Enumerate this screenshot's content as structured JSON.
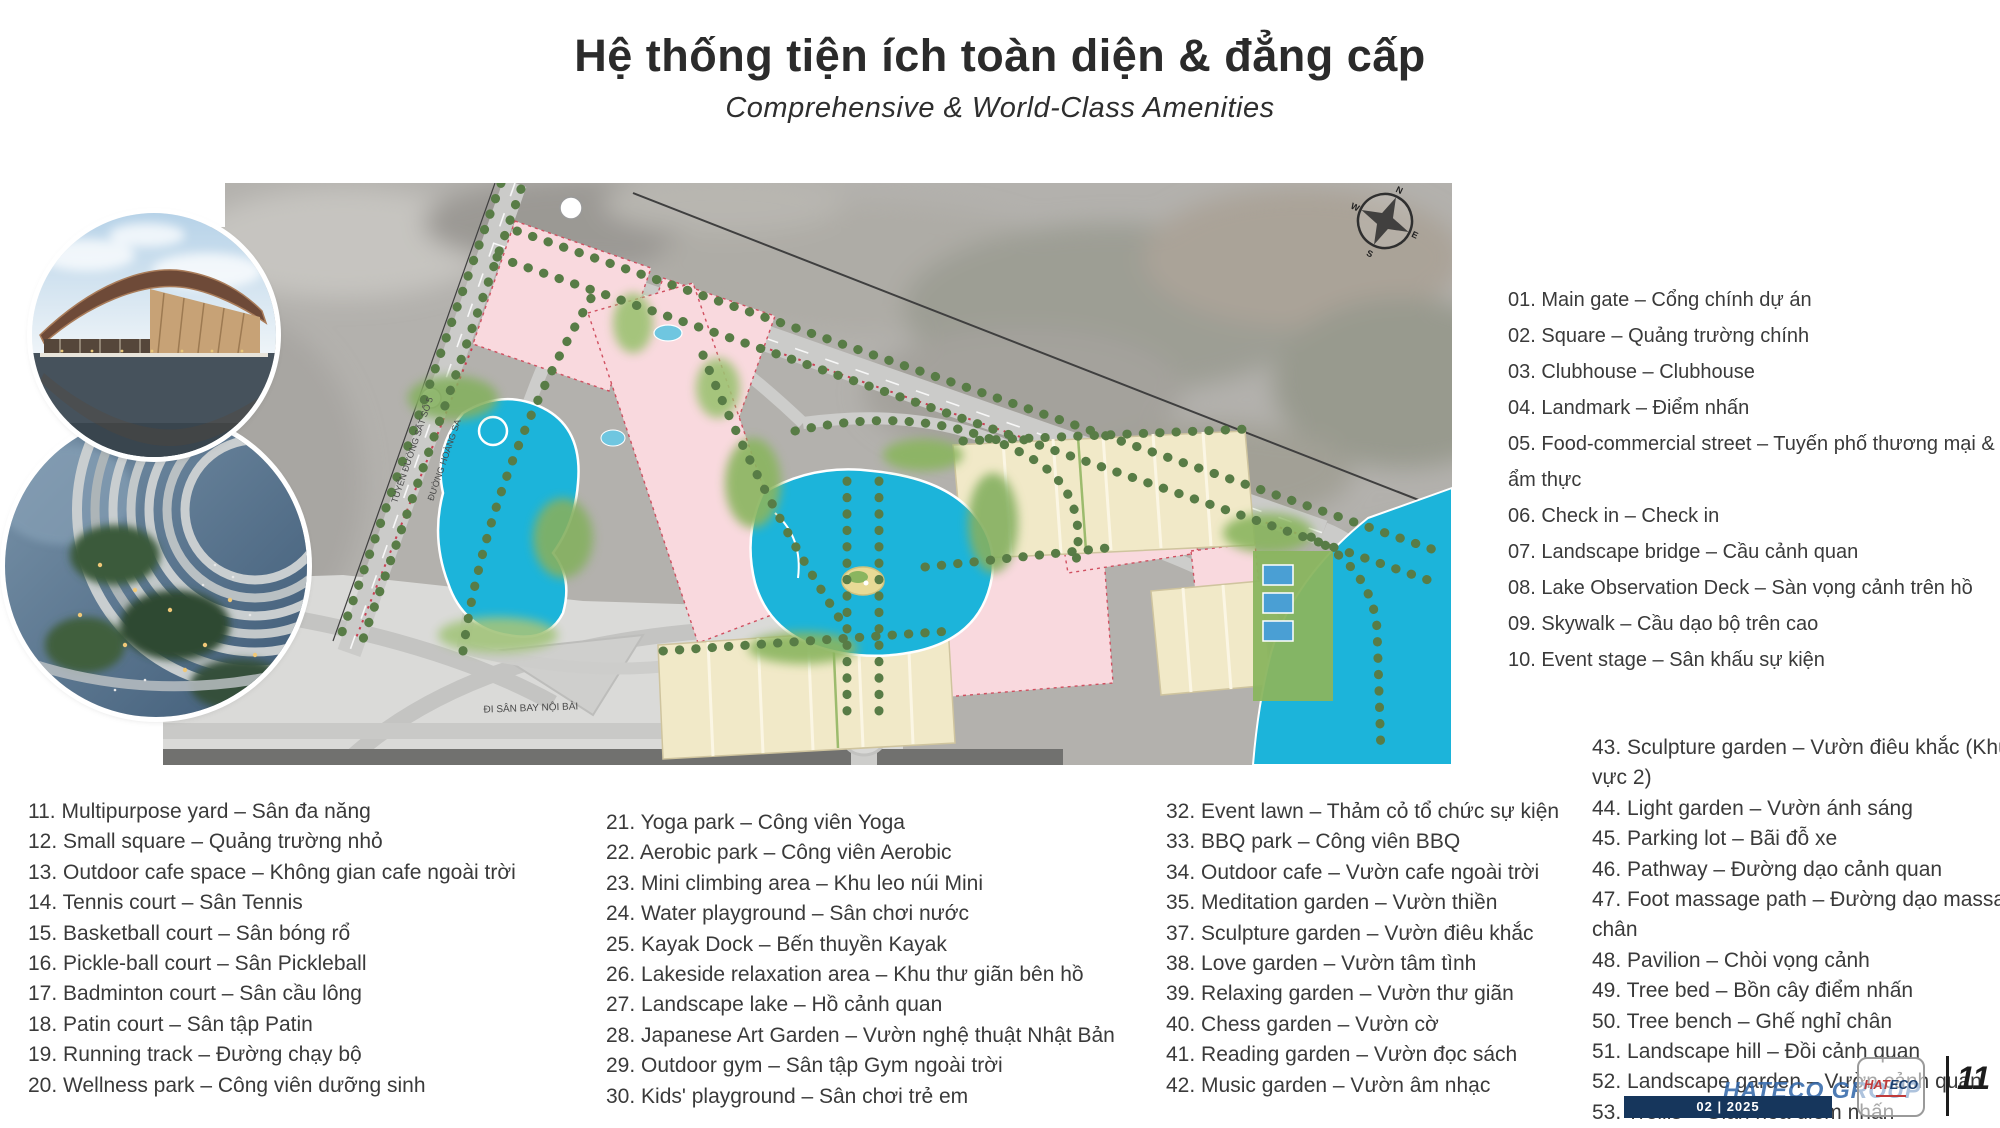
{
  "title": {
    "main": "Hệ thống tiện ích toàn diện & đẳng cấp",
    "subtitle": "Comprehensive & World-Class Amenities"
  },
  "map": {
    "compass": {
      "n": "N",
      "e": "E",
      "s": "S",
      "w": "W"
    },
    "labels": {
      "railway": "TUYẾN ĐƯỜNG SẮT SỐ 5",
      "road_left": "ĐƯỜNG HOÀNG SA",
      "airport": "ĐI SÂN BAY NỘI BÀI"
    },
    "colors": {
      "lake": "#1cb4da",
      "plot_pink": "#f9d9de",
      "rowhouse_cream": "#f1e9c8",
      "road_gray": "#cbcbc9"
    }
  },
  "amenities": {
    "col_right": [
      "01. Main gate – Cổng chính dự án",
      "02. Square – Quảng trường chính",
      "03. Clubhouse – Clubhouse",
      "04. Landmark – Điểm nhấn",
      "05. Food-commercial street – Tuyến phố thương mại & ẩm thực",
      "06. Check in – Check in",
      "07. Landscape bridge – Cầu cảnh quan",
      "08. Lake Observation Deck – Sàn vọng cảnh trên hồ",
      "09. Skywalk – Cầu dạo bộ trên cao",
      "10. Event stage – Sân khấu sự kiện"
    ],
    "col_1": [
      "11. Multipurpose yard – Sân đa năng",
      "12. Small square – Quảng trường nhỏ",
      "13. Outdoor cafe space – Không gian cafe ngoài trời",
      "14. Tennis court – Sân Tennis",
      "15. Basketball court – Sân bóng rổ",
      "16. Pickle-ball court – Sân Pickleball",
      "17. Badminton court – Sân cầu lông",
      "18. Patin court – Sân tập Patin",
      "19. Running track – Đường chạy bộ",
      "20. Wellness park – Công viên dưỡng sinh"
    ],
    "col_2": [
      "21. Yoga park – Công viên Yoga",
      "22. Aerobic park – Công viên Aerobic",
      "23. Mini climbing area – Khu leo núi Mini",
      "24. Water playground – Sân chơi nước",
      "25. Kayak Dock – Bến thuyền Kayak",
      "26. Lakeside relaxation area – Khu thư giãn bên hồ",
      "27. Landscape lake – Hồ cảnh quan",
      "28. Japanese Art Garden – Vườn nghệ thuật Nhật Bản",
      "29. Outdoor gym – Sân tập Gym ngoài trời",
      "30. Kids' playground – Sân chơi trẻ em"
    ],
    "col_3": [
      "32. Event lawn – Thảm cỏ tổ chức sự kiện",
      "33. BBQ park – Công viên BBQ",
      "34. Outdoor cafe – Vườn cafe ngoài trời",
      "35. Meditation garden – Vườn thiền",
      "37. Sculpture garden – Vườn điêu khắc",
      "38. Love garden – Vườn tâm tình",
      "39. Relaxing garden – Vườn thư giãn",
      "40. Chess garden – Vườn cờ",
      "41. Reading garden – Vườn đọc sách",
      "42. Music garden – Vườn âm nhạc"
    ],
    "col_4": [
      "43. Sculpture garden – Vườn điêu khắc (Khu vực 2)",
      "44. Light garden – Vườn ánh sáng",
      "45. Parking lot – Bãi đỗ xe",
      "46. Pathway – Đường dạo cảnh quan",
      "47. Foot massage path – Đường dạo massage chân",
      "48. Pavilion – Chòi vọng cảnh",
      "49. Tree bed – Bồn cây điểm nhấn",
      "50. Tree bench – Ghế nghỉ chân",
      "51. Landscape hill – Đồi cảnh quan",
      "52. Landscape garden – Vườn cảnh quan",
      "53. Trellis – Giàn hoa điểm nhấn"
    ]
  },
  "footer": {
    "brand_watermark": "HATECO GROUP",
    "date_badge": "02 | 2025",
    "logo": {
      "part1": "HAT",
      "part2": "ECO"
    },
    "page_number": "11",
    "colors": {
      "brand_blue": "#2f64a8",
      "badge_navy": "#16365c",
      "logo_red": "#c03a3a"
    }
  }
}
